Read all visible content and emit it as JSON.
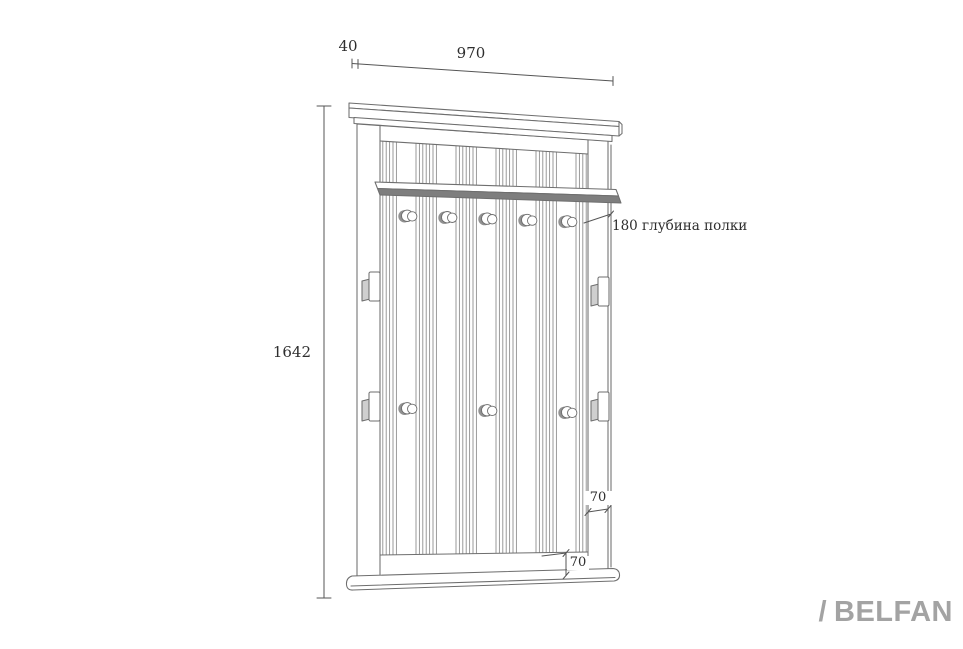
{
  "drawing": {
    "dimensions": {
      "depth_top": "40",
      "width": "970",
      "height": "1642",
      "shelf_note": "180 глубина полки",
      "side_stile_width": "70",
      "bottom_rail_height": "70"
    },
    "hooks": {
      "top_row_count": 5,
      "bottom_row_count": 3
    },
    "wall_brackets_count": 4,
    "colors": {
      "line": "#6e6e6e",
      "dim_line": "#555555",
      "text": "#2e2e2e",
      "shelf_shadow": "#7e7e7e",
      "bracket_shade": "#cfcfcf",
      "hook_shade": "#919191",
      "bead_line": "#8f8f8f",
      "logo": "#a3a3a3",
      "background": "#ffffff"
    }
  },
  "logo": {
    "slash": "/",
    "name": "BELFAN"
  }
}
